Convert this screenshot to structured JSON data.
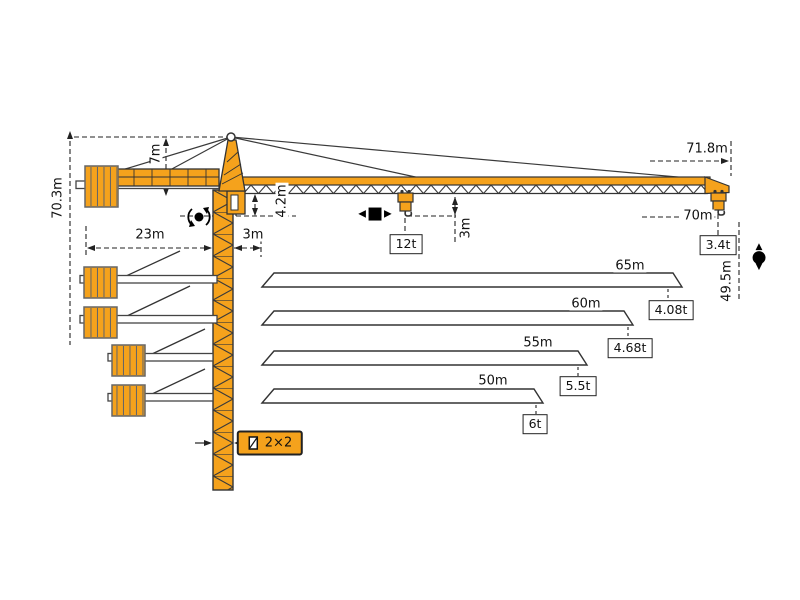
{
  "diagram": {
    "type": "tower-crane-specification-drawing",
    "colors": {
      "crane": "#F5A21C",
      "outline": "#333333",
      "dimension": "#222222"
    },
    "dimensions": {
      "total_height": "70.3m",
      "tower_head_height": "7m",
      "counter_jib_radius": "23m",
      "jib_root_offset": "3m",
      "jib_depth": "4.2m",
      "hook_clearance": "3m",
      "overall_length": "71.8m",
      "tip_radius": "70m",
      "hook_height": "49.5m",
      "mast_section": "2×2"
    },
    "capacities": {
      "max_load": "12t",
      "tip_load": "3.4t"
    },
    "jib_variants": [
      {
        "length": "65m",
        "tip_load": "4.08t"
      },
      {
        "length": "60m",
        "tip_load": "4.68t"
      },
      {
        "length": "55m",
        "tip_load": "5.5t"
      },
      {
        "length": "50m",
        "tip_load": "6t"
      }
    ],
    "icons": {
      "slewing": "slewing-rotation-icon",
      "trolley_travel": "trolley-travel-icon",
      "hoisting": "hoisting-icon",
      "mast_section": "mast-section-icon"
    }
  }
}
